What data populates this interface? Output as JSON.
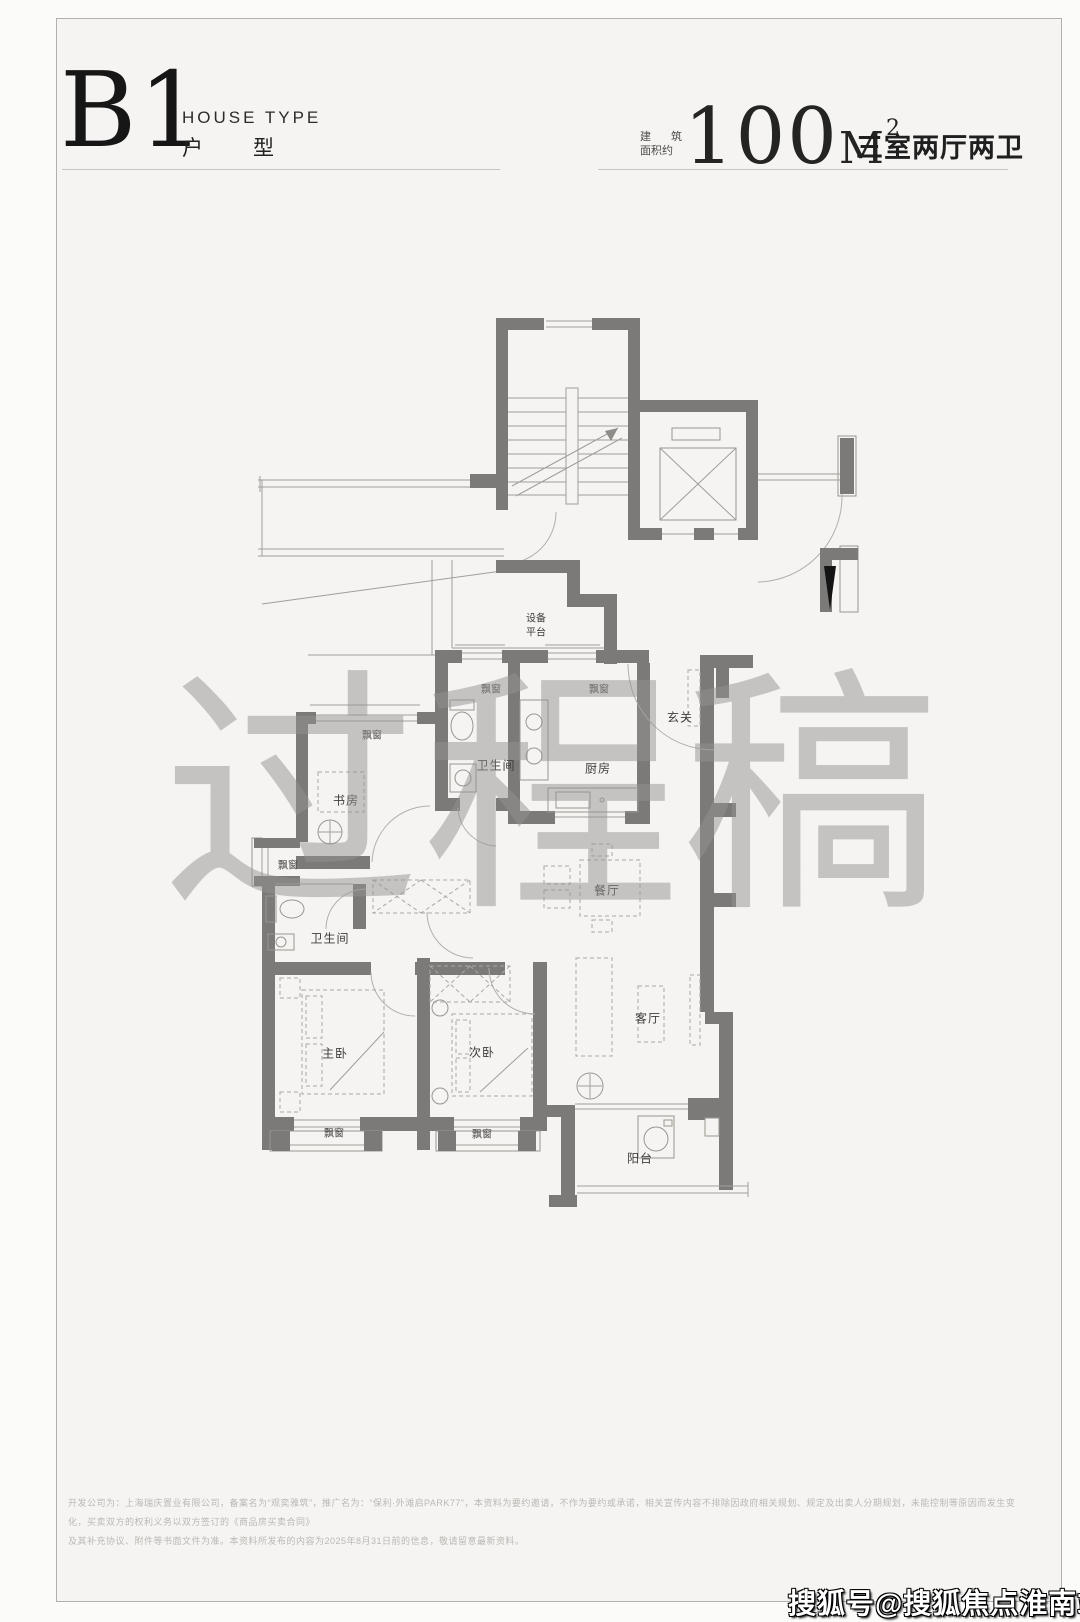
{
  "colors": {
    "wall": "#7c7a78",
    "page_bg": "#f5f4f2",
    "accent_text": "#1c1c1c"
  },
  "header": {
    "type_code": "B1",
    "type_label_en": "HOUSE TYPE",
    "type_label_cn": "户型",
    "area_prefix_line1": "建筑",
    "area_prefix_line2": "面积约",
    "area_value": "100",
    "area_unit": "M",
    "area_unit_sup": "2",
    "layout_summary": "三室两厅两卫"
  },
  "floorplan": {
    "labels": {
      "equipment_line1": "设备",
      "equipment_line2": "平台",
      "bay_window": "飘窗",
      "entry": "玄关",
      "bathroom": "卫生间",
      "kitchen": "厨房",
      "study": "书房",
      "dining": "餐厅",
      "master_bedroom": "主卧",
      "second_bedroom": "次卧",
      "living_room": "客厅",
      "balcony": "阳台"
    }
  },
  "watermark": {
    "text": "过程稿"
  },
  "footer": {
    "disclaimer_line1": "开发公司为：上海瑞庆置业有限公司，备案名为“观奕雅筑”，推广名为：“保利·外滩启PARK77”，本资料为要约邀请，不作为要约或承诺，相关宣传内容不排除因政府相关规划、规定及出卖人分期规划，未能控制等原因而发生变化，买卖双方的权利义务以双方签订的《商品房买卖合同》",
    "disclaimer_line2": "及其补充协议、附件等书面文件为准。本资料所发布的内容为2025年8月31日前的信息，敬请留意最新资料。"
  },
  "badge": {
    "text": "搜狐号@搜狐焦点淮南站"
  }
}
